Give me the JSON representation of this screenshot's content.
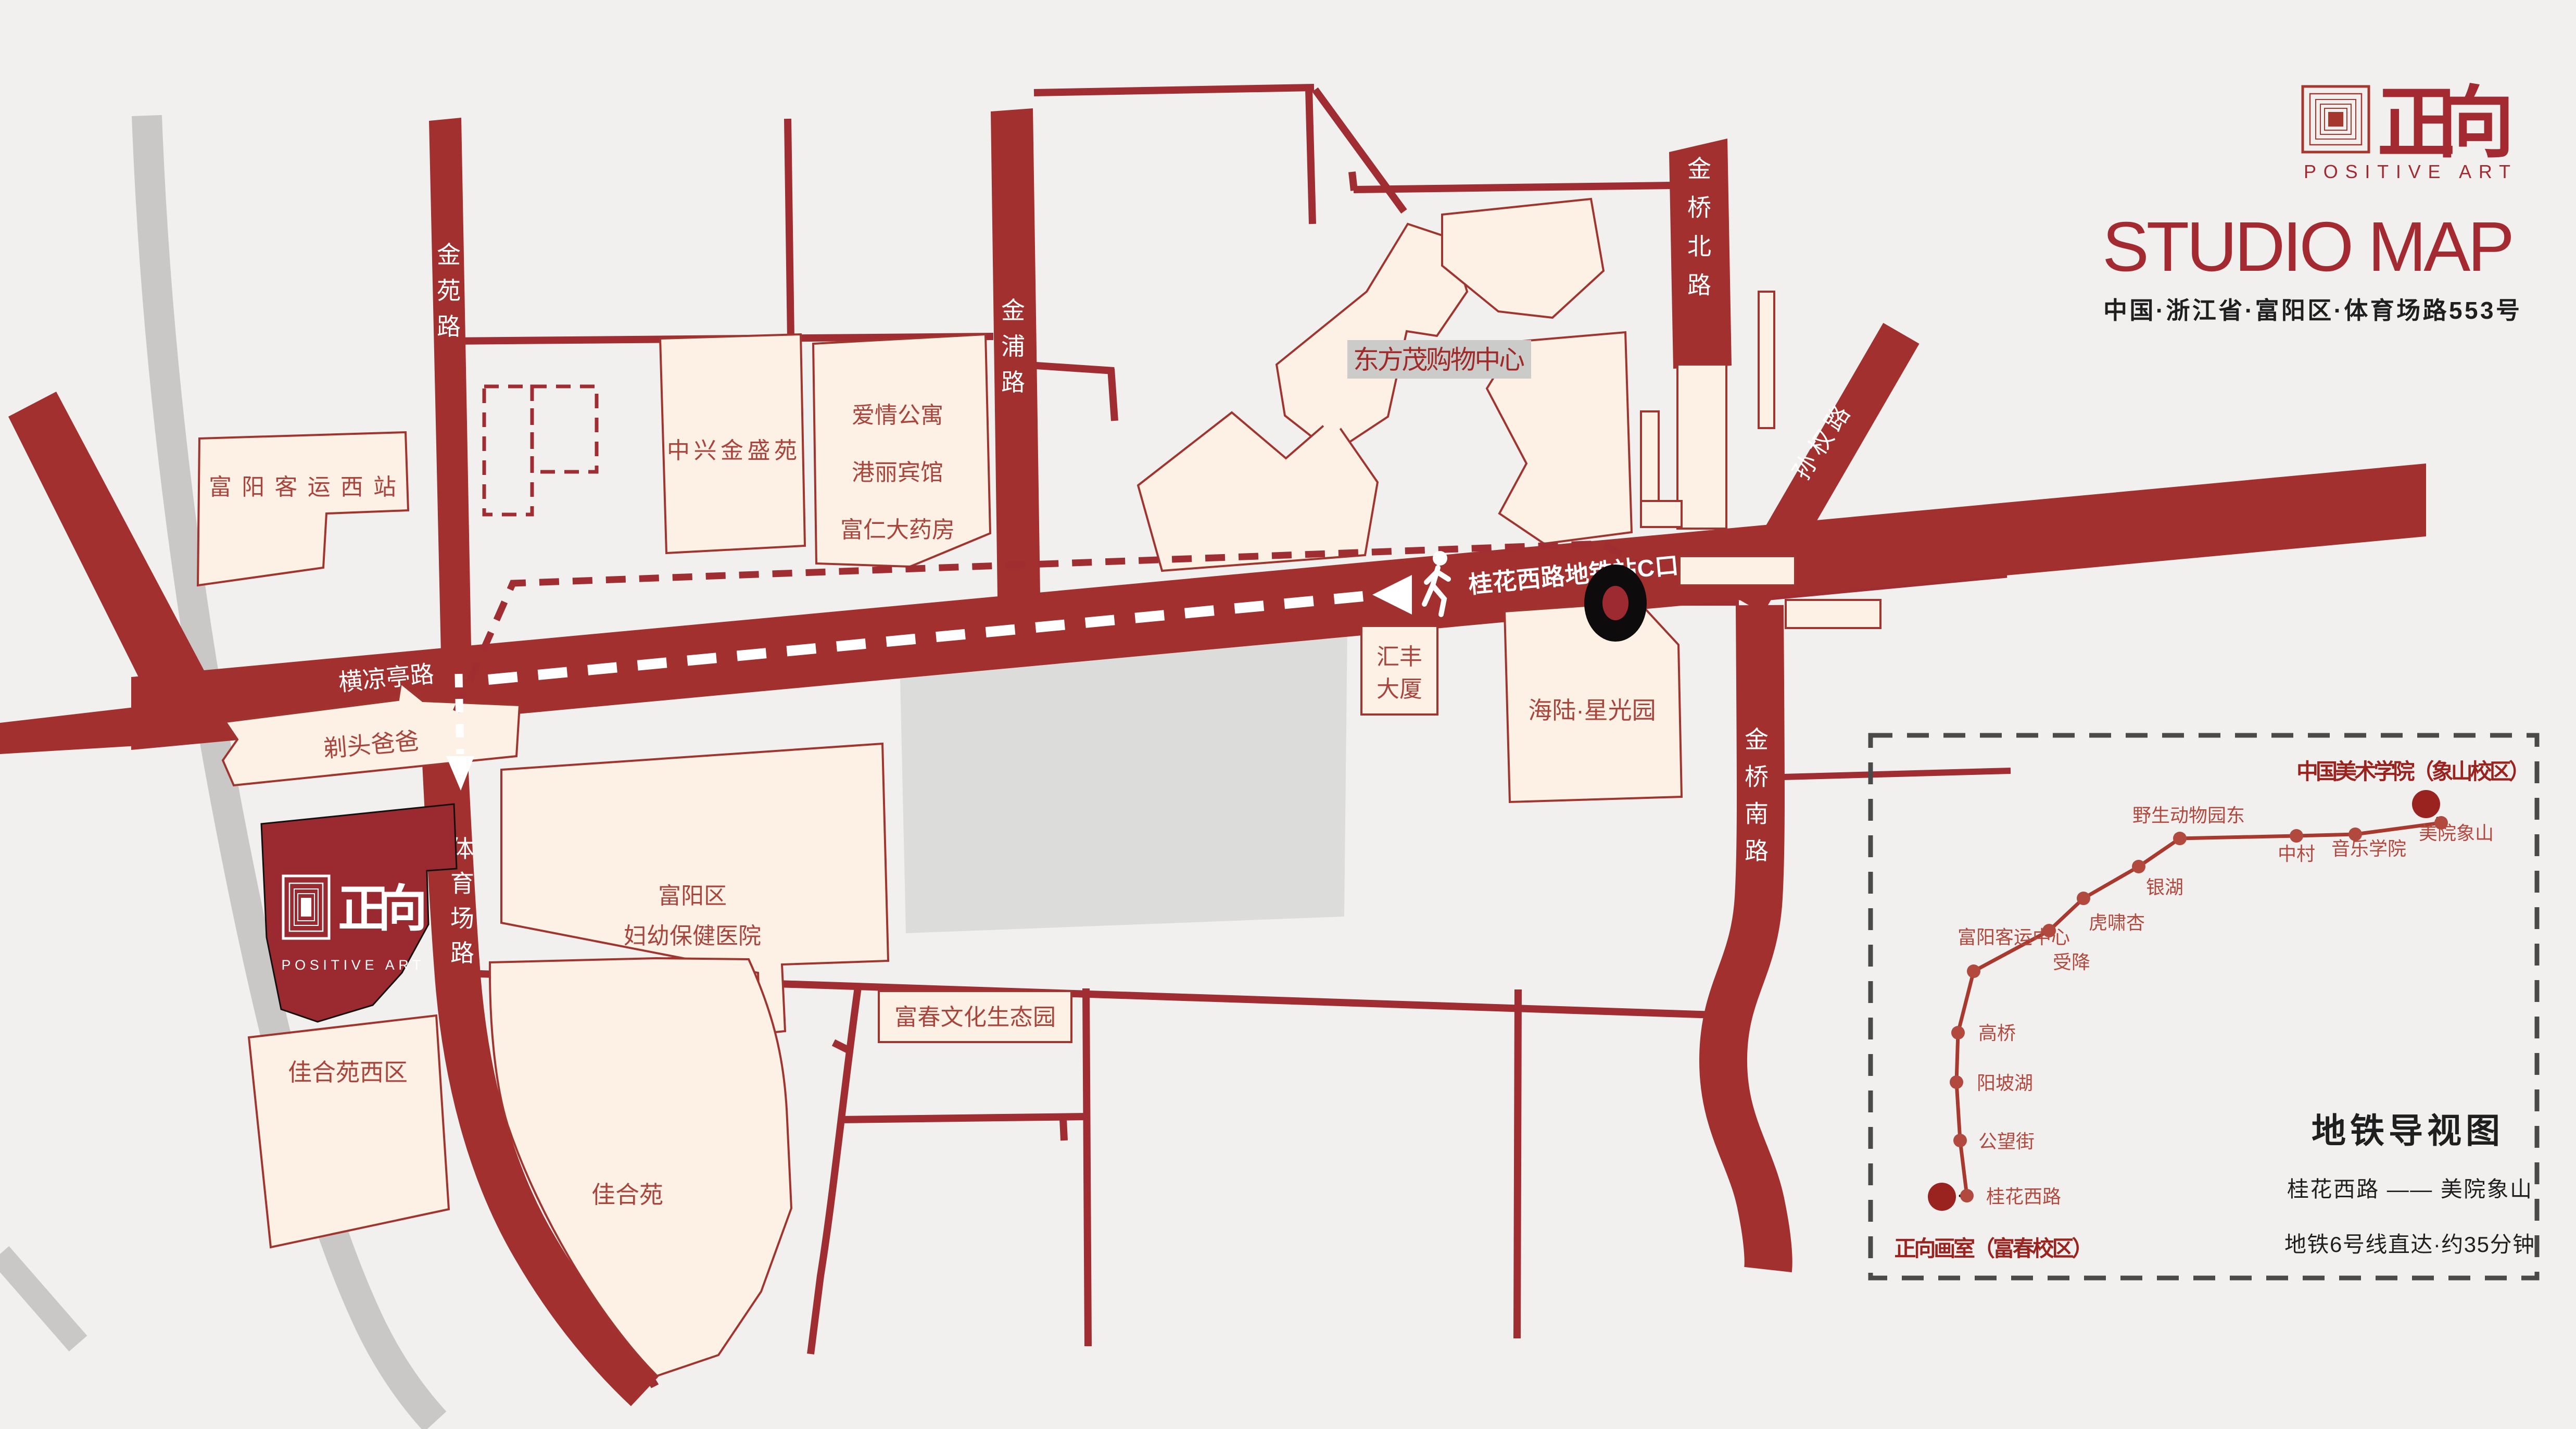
{
  "brand": {
    "cn": "正向",
    "en": "POSITIVE ART"
  },
  "header": {
    "title": "STUDIO MAP",
    "address": "中国·浙江省·富阳区·体育场路553号"
  },
  "roads": {
    "jinyuan": "金苑路",
    "jinpu": "金浦路",
    "jinqiao_north": "金桥北路",
    "sunquan": "孙权路",
    "jinqiao_south": "金桥南路",
    "hengliangting": "横凉亭路",
    "tiyuchang": "体育场路",
    "metro_exit": "桂花西路地铁站C口"
  },
  "buildings": {
    "fuyang_west_station": "富阳客运西站",
    "zhongxing": "中兴金盛苑",
    "aiqing": "爱情公寓",
    "gangli": "港丽宾馆",
    "furen": "富仁大药房",
    "dongfangmao": "东方茂购物中心",
    "huifeng_l1": "汇丰",
    "huifeng_l2": "大厦",
    "hailu": "海陆·星光园",
    "hospital_l1": "富阳区",
    "hospital_l2": "妇幼保健医院",
    "titou": "剃头爸爸",
    "jiaheyuan_west": "佳合苑西区",
    "jiaheyuan": "佳合苑",
    "fuchun_park": "富春文化生态园"
  },
  "metro": {
    "panel_title": "地铁导视图",
    "origin": "正向画室（富春校区）",
    "destination": "中国美术学院（象山校区）",
    "route": "桂花西路 —— 美院象山",
    "note": "地铁6号线直达·约35分钟",
    "stations": [
      "桂花西路",
      "公望街",
      "阳坡湖",
      "高桥",
      "富阳客运中心",
      "受降",
      "虎啸杏",
      "银湖",
      "野生动物园东",
      "中村",
      "音乐学院",
      "美院象山"
    ]
  },
  "colors": {
    "road_red": "#a2302f",
    "brand_red": "#a32a31",
    "cream": "#fdf0e4",
    "gray_road": "#c9c8c7",
    "gray_block": "#dcdcdb",
    "label_red": "#a8453c",
    "station_red": "#b2493e",
    "black": "#1f1f1f"
  }
}
